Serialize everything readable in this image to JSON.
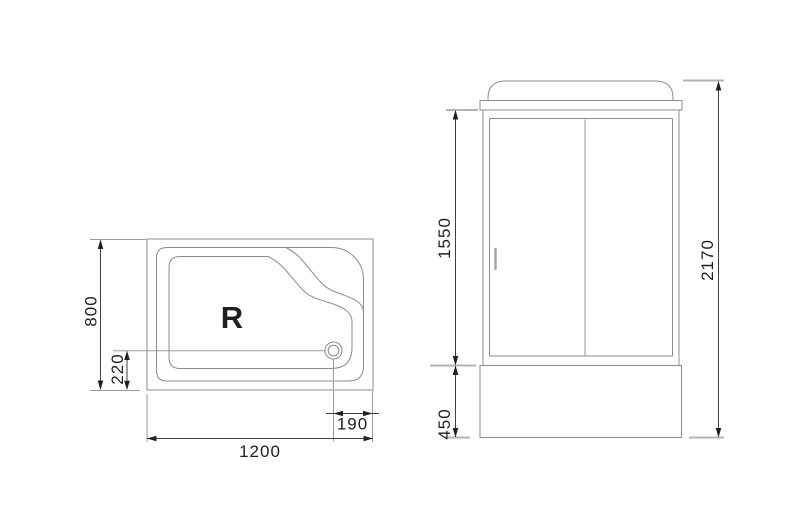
{
  "diagram": {
    "plan_view": {
      "orientation_label": "R",
      "dim_depth": "800",
      "dim_drain_from_bottom": "220",
      "dim_width": "1200",
      "dim_drain_from_right": "190"
    },
    "front_view": {
      "dim_door_height": "1550",
      "dim_tray_height": "450",
      "dim_total_height": "2170"
    },
    "colors": {
      "outline": "#8c8c8c",
      "light_line": "#b3b3b3",
      "dimension_line": "#3f3f3f",
      "text": "#1f1f1f",
      "background": "#ffffff"
    }
  }
}
